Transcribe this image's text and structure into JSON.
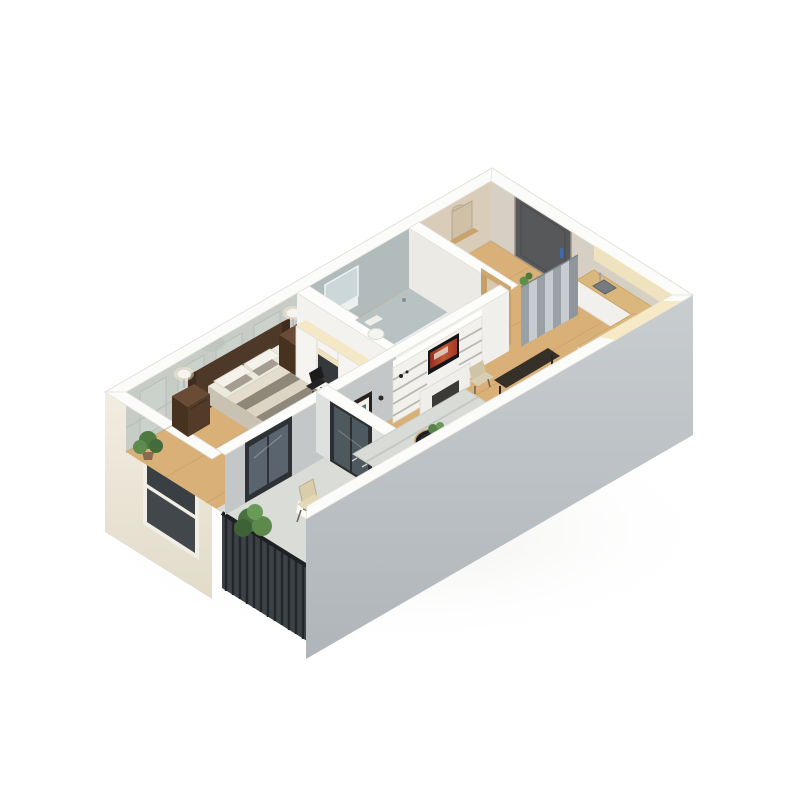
{
  "scene": {
    "title": "3D isometric floor plan render of a one-bedroom apartment",
    "description": "Cutaway axonometric model on a white background showing bedroom, bathroom, entry hall, kitchen, living room and balcony with furniture",
    "background": "#ffffff",
    "projection": "isometric",
    "visible_text": "none"
  },
  "palette": {
    "background": "#ffffff",
    "roof_band": "#fbfbf9",
    "exterior_sw_wall": "#efe8db",
    "exterior_se_wall": "#bec3c6",
    "floor_wood": "#d8b078",
    "floor_balcony": "#dadcd7",
    "floor_bathroom": "#a3abad",
    "bedroom_wall_panels": "#c7ccc7",
    "bathroom_wall": "#b2bbbb",
    "entry_wall_beige": "#d9cdb9",
    "ne_wall_greige": "#d6cfc3",
    "hall_wall_gray": "#c3c7c8",
    "interior_wall_white": "#f7f6f3",
    "door_dark": "#56585a",
    "door_handle_blue": "#3e6cab",
    "balcony_door_glass": "#4e585f",
    "duvet_gray": "#8f8779",
    "duvet_cream": "#ddd5c4",
    "headboard_wood": "#4e3827",
    "nightstand_wood": "#6a4c36",
    "rug_gray": "#d8dbd6",
    "plant_green": "#5d8a4c",
    "tv_screen_red": "#a3372b",
    "counter_wood": "#dab77c",
    "cooktop_black": "#2c2a28",
    "divider_pleat_gray": "#aab2b8",
    "railing_dark": "#363b3f",
    "lit_cream": "#f3e5bd"
  },
  "rooms": {
    "bedroom": {
      "label": "Bedroom"
    },
    "bathroom": {
      "label": "Bathroom"
    },
    "entry": {
      "label": "Entry hall"
    },
    "kitchen": {
      "label": "Kitchen"
    },
    "living_room": {
      "label": "Living room"
    },
    "balcony": {
      "label": "Balcony"
    }
  },
  "furniture": {
    "bed": {
      "label": "Double bed with striped duvet"
    },
    "nightstand_left": {
      "label": "Left nightstand with lamp"
    },
    "nightstand_right": {
      "label": "Right nightstand with lamp"
    },
    "bedroom_rug": {
      "label": "Bedroom rug"
    },
    "bedroom_plant": {
      "label": "Potted plant"
    },
    "wardrobe_desk": {
      "label": "Wardrobe with desk nook"
    },
    "desk_chair": {
      "label": "Black desk chair"
    },
    "bedroom_window": {
      "label": "Bedroom window"
    },
    "shower": {
      "label": "Shower"
    },
    "vanity": {
      "label": "Bathroom vanity with sink"
    },
    "toilet": {
      "label": "Toilet"
    },
    "bathroom_mirror": {
      "label": "Bathroom mirror"
    },
    "entry_door": {
      "label": "Entry door with blue handle"
    },
    "hall_cabinet": {
      "label": "Tall hall cabinet"
    },
    "arch_mirror": {
      "label": "Arched wall mirror with console"
    },
    "bathroom_door_frame": {
      "label": "Wooden bathroom door frame"
    },
    "tv_unit": {
      "label": "White TV shelving unit"
    },
    "tv": {
      "label": "Television"
    },
    "picture_frame": {
      "label": "Framed wall art"
    },
    "room_divider": {
      "label": "Pleated room-divider screen"
    },
    "kitchen_counter": {
      "label": "L-shaped kitchen counter"
    },
    "kitchen_sink": {
      "label": "Kitchen sink"
    },
    "cooktop": {
      "label": "Black cooktop"
    },
    "coffee_tables": {
      "label": "Round black nesting coffee tables"
    },
    "living_rug": {
      "label": "Striped living room rug"
    },
    "dining_table": {
      "label": "Small dark dining table"
    },
    "dining_chair": {
      "label": "Beige dining chair"
    },
    "balcony_door_bedroom": {
      "label": "Glazed balcony door from bedroom"
    },
    "balcony_door_living": {
      "label": "Glazed balcony door from living room"
    },
    "balcony_chair": {
      "label": "Folding balcony chair"
    },
    "balcony_plant": {
      "label": "Balcony shrub"
    },
    "railing": {
      "label": "Dark slatted balcony railing"
    }
  }
}
